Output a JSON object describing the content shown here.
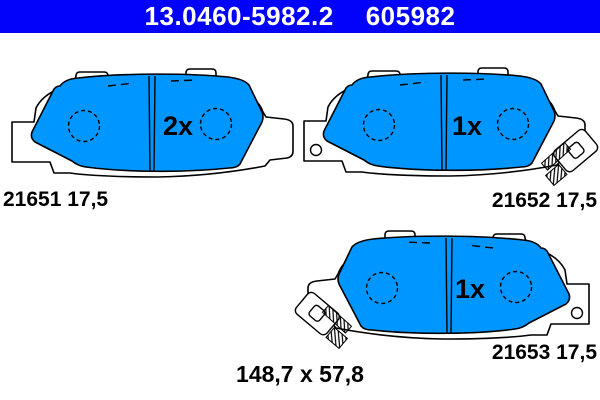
{
  "header": {
    "catalog_number": "13.0460-5982.2",
    "reference_number": "605982"
  },
  "pads": [
    {
      "part_number": "21651",
      "thickness": "17,5",
      "count_label": "2x",
      "part_label": "21651 17,5"
    },
    {
      "part_number": "21652",
      "thickness": "17,5",
      "count_label": "1x",
      "part_label": "21652 17,5"
    },
    {
      "part_number": "21653",
      "thickness": "17,5",
      "count_label": "1x",
      "part_label": "21653 17,5"
    }
  ],
  "dimensions_label": "148,7 x 57,8",
  "colors": {
    "header_bg": "#0202FB",
    "header_text": "#FFFFFF",
    "pad_fill": "#0096FF",
    "outline": "#000000",
    "background": "#FFFFFF"
  }
}
